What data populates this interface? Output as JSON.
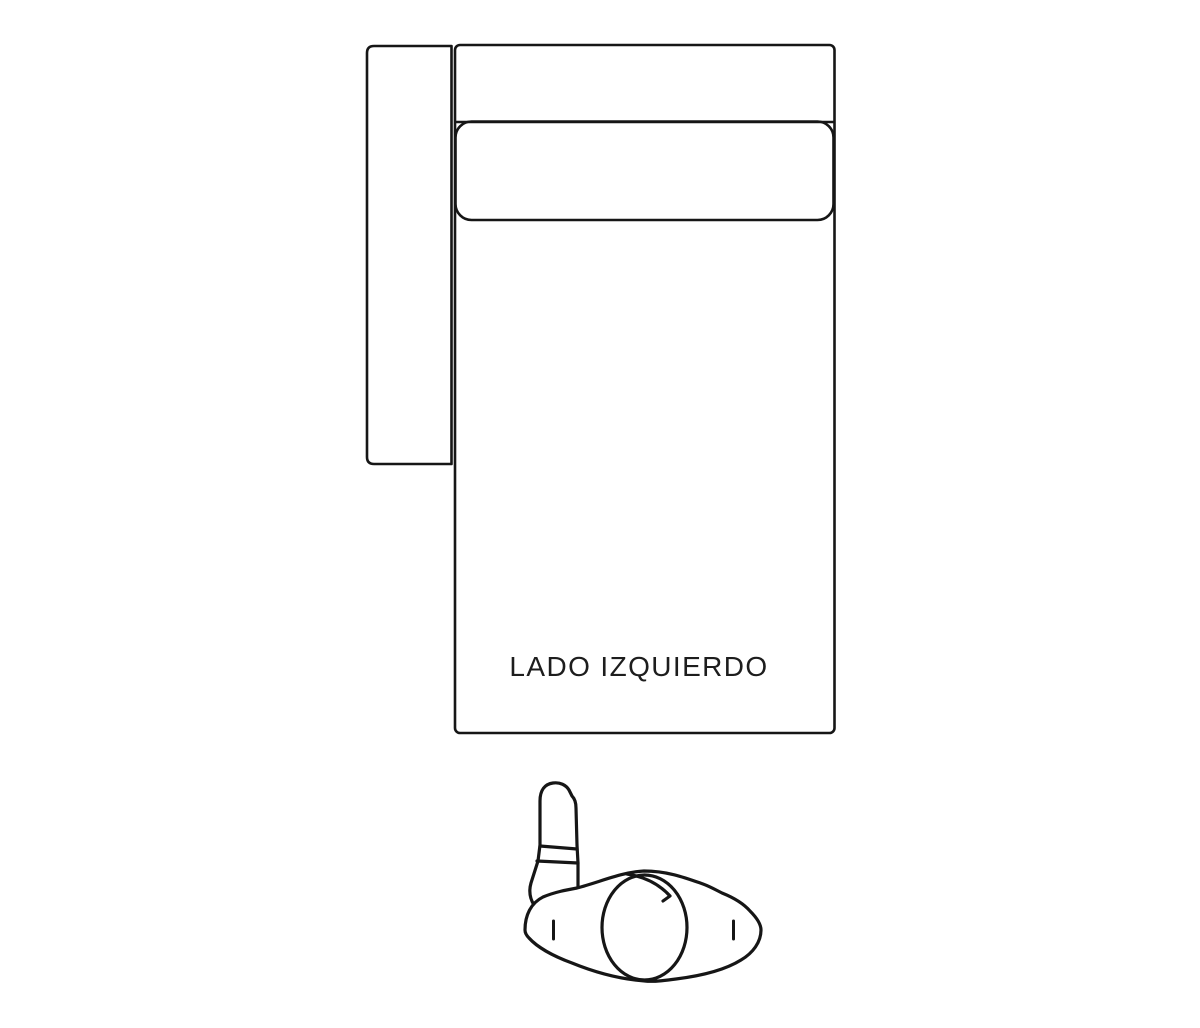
{
  "page": {
    "background_color": "#ffffff"
  },
  "diagram": {
    "label": "LADO IZQUIERDO",
    "stroke_color": "#161616",
    "text_color": "#1d1d1d",
    "fill_color": "#ffffff",
    "icons": {
      "person_figure": "person-top-view-outline",
      "sofa_module": "sofa-left-side-top-view"
    }
  }
}
